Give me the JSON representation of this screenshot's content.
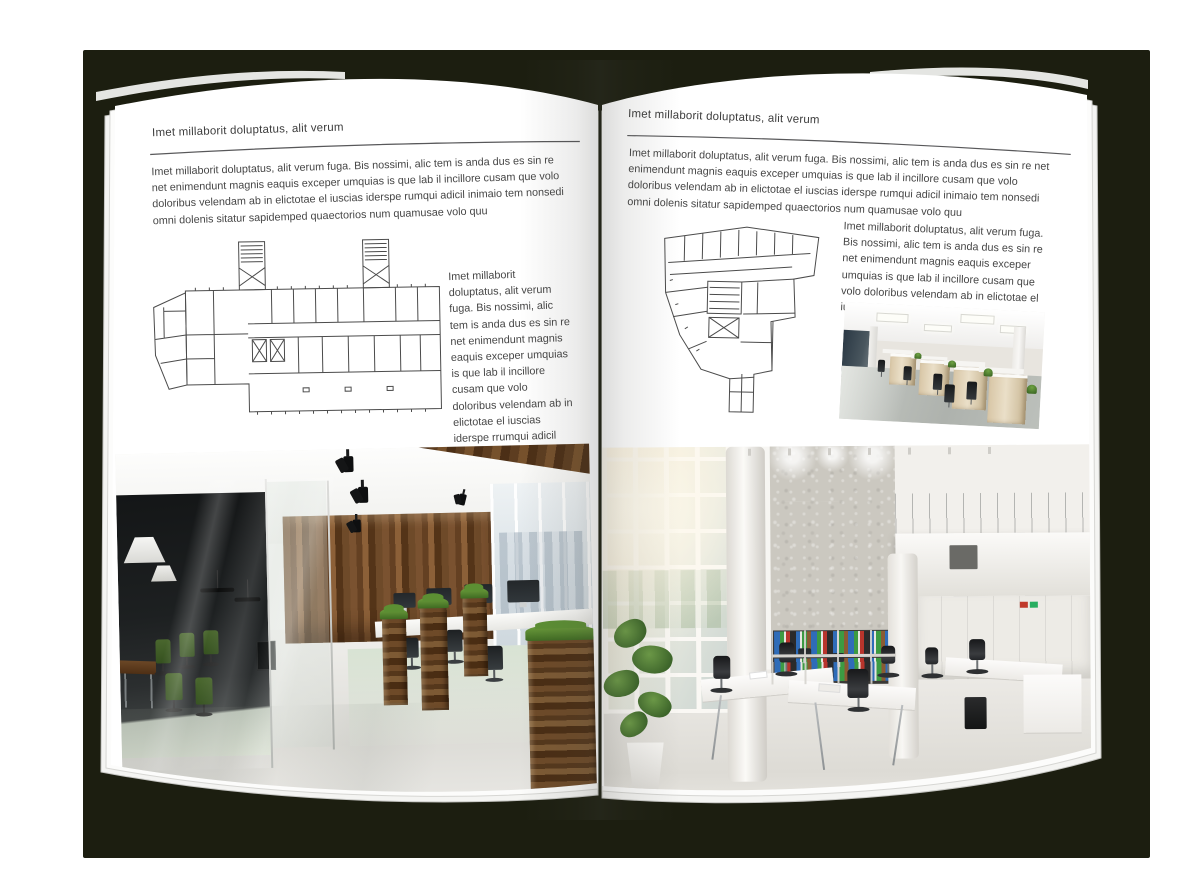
{
  "colors": {
    "backdrop_shadow": "#1c1e10",
    "page": "#ffffff",
    "text": "#464646",
    "rule": "#58585a"
  },
  "left_page": {
    "header": "Imet millaborit doluptatus, alit verum",
    "intro": "Imet millaborit doluptatus, alit verum fuga. Bis nossimi, alic tem is anda dus es sin re net enimendunt magnis eaquis exceper umquias is que lab il incillore cusam que volo doloribus velendam ab in elictotae el iuscias iderspe rumqui adicil inimaio tem nonsedi omni dolenis sitatur sapidemped quaectorios num quamusae volo quu",
    "side_text": "Imet millaborit doluptatus, alit verum fuga. Bis nossimi, alic tem is anda dus es sin re net enimendunt magnis eaquis exceper umquias is que lab il incillore cusam que volo doloribus velendam ab in elictotae el iuscias iderspe rrumqui adicil inimaio tem nonsedi omni dolenis sitatur sapidemped quaectorios num quamusae volo quu",
    "floor_plan_alt": "Wide building floor plan with two stair towers and angled left wing",
    "photo_alt": "Office interior with dark glass meeting room, green chairs, wooden wall panels, planters and workstations"
  },
  "right_page": {
    "header": "Imet millaborit doluptatus, alit verum",
    "intro": "Imet millaborit doluptatus, alit verum fuga. Bis nossimi, alic tem is anda dus es sin re net enimendunt magnis eaquis exceper umquias is que lab il incillore cusam que volo doloribus velendam ab in elictotae el iuscias iderspe rumqui adicil inimaio tem nonsedi omni dolenis sitatur sapidemped quaectorios num quamusae volo quu",
    "side_text": "Imet millaborit doluptatus, alit verum fuga. Bis nossimi, alic tem is anda dus es sin re net enimendunt magnis eaquis exceper umquias is que lab il incillore cusam que volo doloribus velendam ab in elictotae el iuscias iders",
    "floor_plan_alt": "Irregular tower floor plan tapering to a lower stem",
    "small_photo_alt": "Open plan office with rows of light wood desks and black chairs",
    "large_photo_alt": "Bright double-height white office with concrete wall, binder shelves and white desks"
  }
}
